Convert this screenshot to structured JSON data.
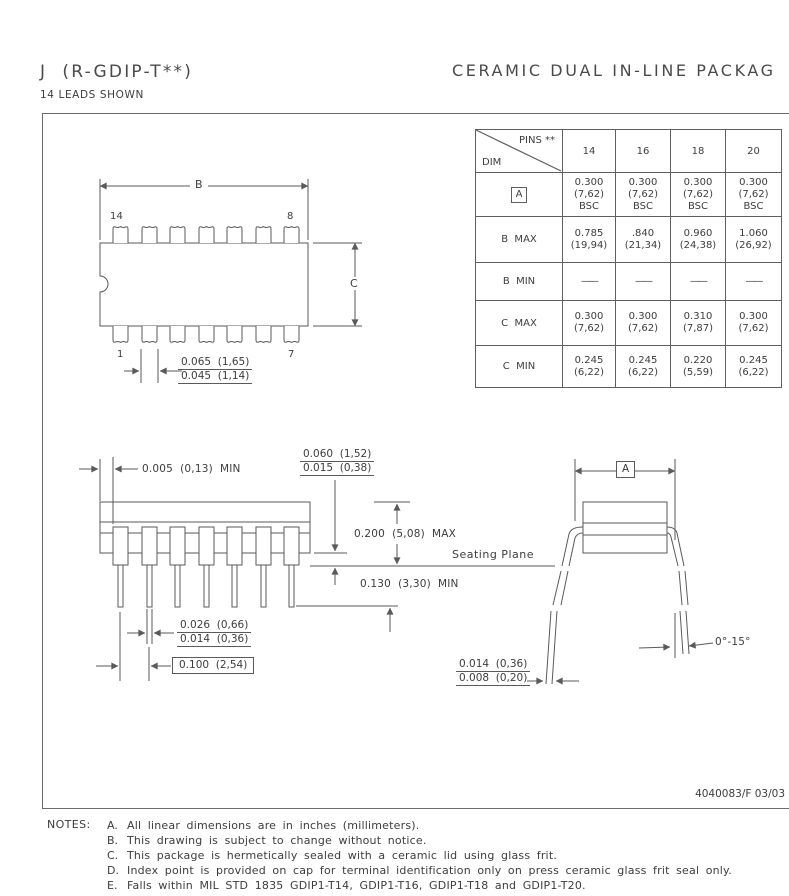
{
  "header": {
    "title_left": "J  (R-GDIP-T**)",
    "subtitle_left": "14 LEADS SHOWN",
    "title_right": "CERAMIC  DUAL  IN-LINE  PACKAG"
  },
  "table": {
    "corner_top": "PINS **",
    "corner_bottom": "DIM",
    "columns": [
      "14",
      "16",
      "18",
      "20"
    ],
    "rows": [
      {
        "label": "A",
        "values": [
          "0.300\n(7,62)\nBSC",
          "0.300\n(7,62)\nBSC",
          "0.300\n(7,62)\nBSC",
          "0.300\n(7,62)\nBSC"
        ]
      },
      {
        "label": "B  MAX",
        "values": [
          "0.785\n(19,94)",
          ".840\n(21,34)",
          "0.960\n(24,38)",
          "1.060\n(26,92)"
        ]
      },
      {
        "label": "B  MIN",
        "values": [
          "——",
          "——",
          "——",
          "——"
        ]
      },
      {
        "label": "C  MAX",
        "values": [
          "0.300\n(7,62)",
          "0.300\n(7,62)",
          "0.310\n(7,87)",
          "0.300\n(7,62)"
        ]
      },
      {
        "label": "C  MIN",
        "values": [
          "0.245\n(6,22)",
          "0.245\n(6,22)",
          "0.220\n(5,59)",
          "0.245\n(6,22)"
        ]
      }
    ]
  },
  "top_view": {
    "dim_b": "B",
    "dim_c": "C",
    "pin14": "14",
    "pin8": "8",
    "pin1": "1",
    "pin7": "7",
    "lead_width_max": "0.065  (1,65)",
    "lead_width_min": "0.045  (1,14)"
  },
  "side_view": {
    "edge_clearance": "0.005  (0,13)  MIN",
    "shoulder_max": "0.060  (1,52)",
    "shoulder_min": "0.015  (0,38)",
    "body_height": "0.200  (5,08)  MAX",
    "seating_plane": "Seating Plane",
    "standoff": "0.130  (3,30)  MIN",
    "lead_w_max": "0.026  (0,66)",
    "lead_w_min": "0.014  (0,36)",
    "pitch": "0.100  (2,54)"
  },
  "end_view": {
    "dim_a": "A",
    "lead_t_max": "0.014  (0,36)",
    "lead_t_min": "0.008  (0,20)",
    "angle": "0°-15°"
  },
  "footer": {
    "doc_number": "4040083/F 03/03"
  },
  "notes": {
    "label": "NOTES:",
    "items": [
      {
        "letter": "A.",
        "text": "All linear dimensions are in inches (millimeters)."
      },
      {
        "letter": "B.",
        "text": "This drawing is subject to change without notice."
      },
      {
        "letter": "C.",
        "text": "This package is hermetically sealed with a ceramic lid using glass frit."
      },
      {
        "letter": "D.",
        "text": "Index point is provided on cap for terminal identification only on press ceramic glass frit seal only."
      },
      {
        "letter": "E.",
        "text": "Falls within MIL STD 1835 GDIP1-T14, GDIP1-T16, GDIP1-T18 and GDIP1-T20."
      }
    ]
  }
}
